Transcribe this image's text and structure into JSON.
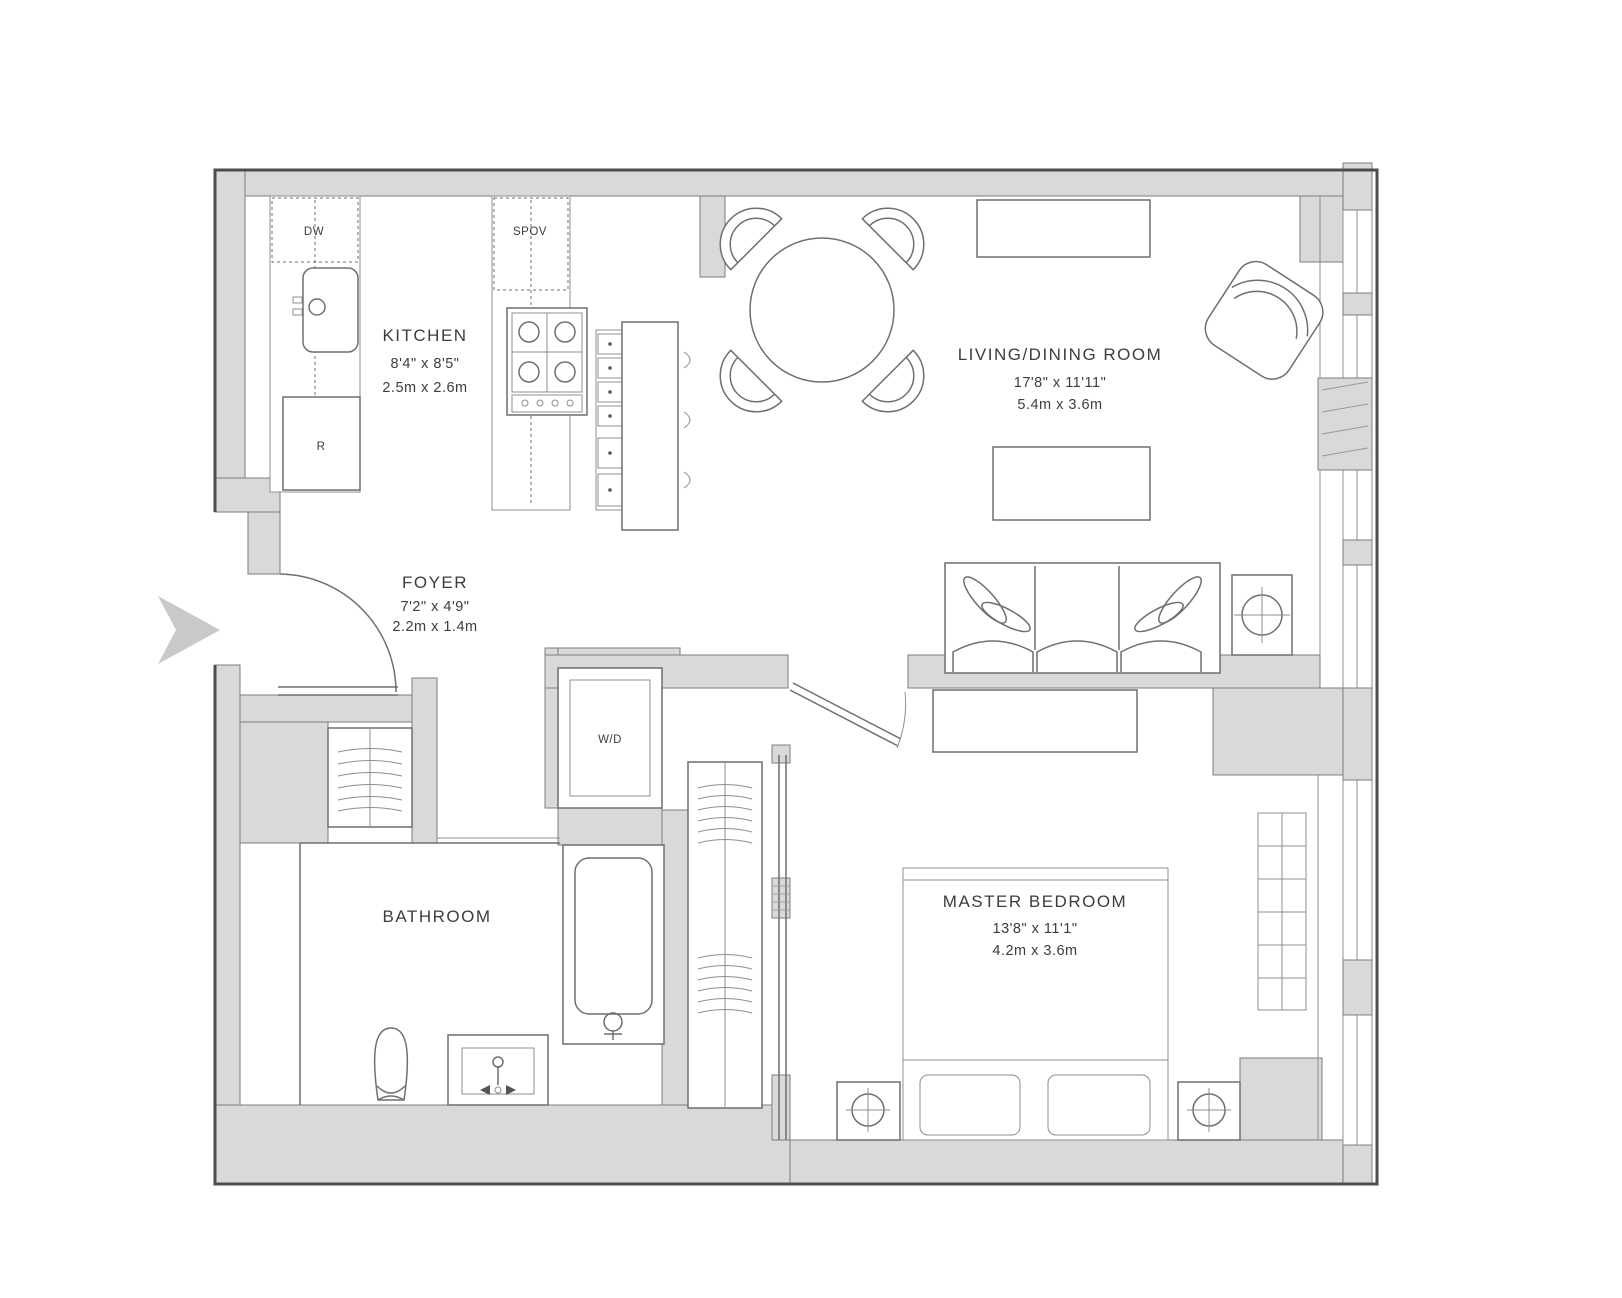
{
  "floorplan": {
    "rooms": {
      "kitchen": {
        "name": "KITCHEN",
        "imperial": "8'4\" x 8'5\"",
        "metric": "2.5m x 2.6m"
      },
      "living_dining": {
        "name": "LIVING/DINING ROOM",
        "imperial": "17'8\" x 11'11\"",
        "metric": "5.4m x 3.6m"
      },
      "foyer": {
        "name": "FOYER",
        "imperial": "7'2\" x 4'9\"",
        "metric": "2.2m x 1.4m"
      },
      "master_bedroom": {
        "name": "MASTER BEDROOM",
        "imperial": "13'8\" x 11'1\"",
        "metric": "4.2m x 3.6m"
      },
      "bathroom": {
        "name": "BATHROOM"
      }
    },
    "appliances": {
      "dishwasher": "DW",
      "oven": "SPOV",
      "refrigerator": "R",
      "washer_dryer": "W/D"
    },
    "colors": {
      "background": "#ffffff",
      "wall_fill": "#d9d9d9",
      "outline": "#4d4d4d",
      "furniture_line": "#6f6f6f",
      "text": "#3d3d3d",
      "entry_arrow": "#c9c9c9"
    }
  }
}
